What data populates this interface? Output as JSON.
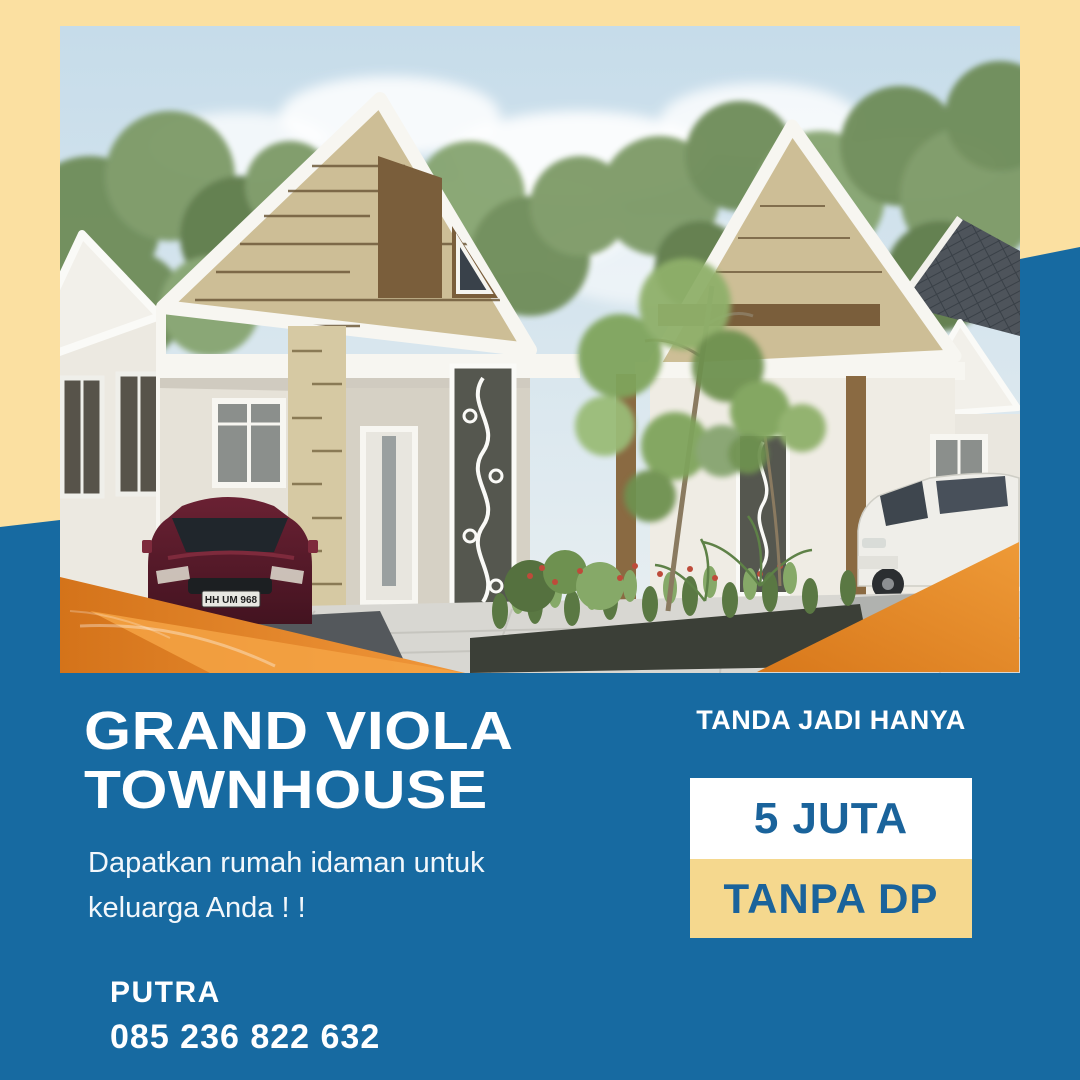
{
  "poster": {
    "title_line1": "GRAND VIOLA",
    "title_line2": "TOWNHOUSE",
    "subtitle_line1": "Dapatkan rumah idaman untuk",
    "subtitle_line2": "keluarga Anda ! !",
    "contact": {
      "name": "PUTRA",
      "phone": "085 236 822 632"
    },
    "promo": {
      "label": "TANDA JADI HANYA",
      "price": "5 JUTA",
      "down_payment": "TANPA DP"
    },
    "photo": {
      "description": "3D render of modern gable townhouses with garden, maroon sedan and white minivan",
      "license_plate": "HH UM 968"
    },
    "colors": {
      "background_yellow": "#FBE0A1",
      "primary_blue": "#176AA1",
      "accent_orange": "#DE7E1D",
      "price_box_white": "#FFFFFF",
      "dp_box_yellow": "#F5D88E",
      "box_text_blue": "#1A639B"
    }
  }
}
